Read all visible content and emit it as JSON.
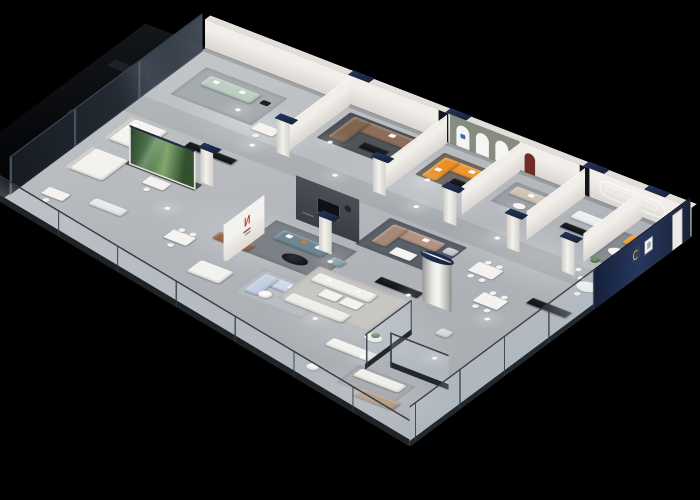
{
  "scene": {
    "description": "Photorealistic isometric 3D cutaway render of a furniture showroom floor plan glowing against a pure black background",
    "view": "axonometric bird's-eye from the south-east",
    "background": "#000000"
  },
  "palette": {
    "floor": "#b5b9bd",
    "walls": "#edeae5",
    "navy_caps": "#1d2b45",
    "exterior_navy": "#1b2740",
    "orange_sofa": "#f0982f",
    "sage_sofa": "#bccfc2",
    "brown_sectional": "#8d6e5a",
    "taupe_sectional": "#b29384",
    "teal_sofa": "#6d8894",
    "pale_blue_sofa": "#cdd8eb",
    "leather_brown": "#96684a",
    "tan_sofa": "#b49e8a",
    "charcoal_wall": "#42474e",
    "plant_glass_green": "#4a7350",
    "glass_tint": "#9fb4c2",
    "logo_red": "#c2382c"
  },
  "logo": {
    "glyph": "N",
    "color": "#c2382c"
  },
  "zones": [
    {
      "name": "dark-gallery",
      "position": "north-west behind tinted glass",
      "items": [
        "tinted glass facade panels",
        "dark lounge sofa",
        "plant silhouette"
      ]
    },
    {
      "name": "west-displays",
      "items": [
        "sage green sofa",
        "white display beds",
        "black media consoles",
        "white desks with chairs"
      ]
    },
    {
      "name": "brown-sofa-room",
      "items": [
        "brown sectional sofa",
        "charcoal rug",
        "black coffee table",
        "grey armchair"
      ]
    },
    {
      "name": "arch-alcove-room",
      "items": [
        "three arched display niches",
        "orange L-shaped sofa with white pillows",
        "black coffee table"
      ]
    },
    {
      "name": "center-lounge",
      "items": [
        "charcoal feature wall with TV",
        "teal sofa with orange pillow",
        "black round coffee table",
        "teal ottoman",
        "taupe sectional",
        "red logo wall",
        "green plant glass case"
      ]
    },
    {
      "name": "dining-displays",
      "items": [
        "white dining tables with chairs",
        "glass dividers",
        "white cylinder column with navy cap",
        "cognac armchair"
      ]
    },
    {
      "name": "east-orange-room",
      "items": [
        "orange L-shaped sofa",
        "navy exterior wall",
        "two wall frames",
        "white oval coffee table",
        "round dining table with chairs",
        "white wardrobe"
      ]
    },
    {
      "name": "front-gallery",
      "items": [
        "white sofa group with square coffee tables",
        "glass balustrade with dark rail",
        "tall glass partitions",
        "tan sofa",
        "pale blue sofas",
        "potted plant on round table"
      ]
    }
  ],
  "lighting": {
    "downlights": 18,
    "style": "warm white light pools on grey concrete floor"
  }
}
